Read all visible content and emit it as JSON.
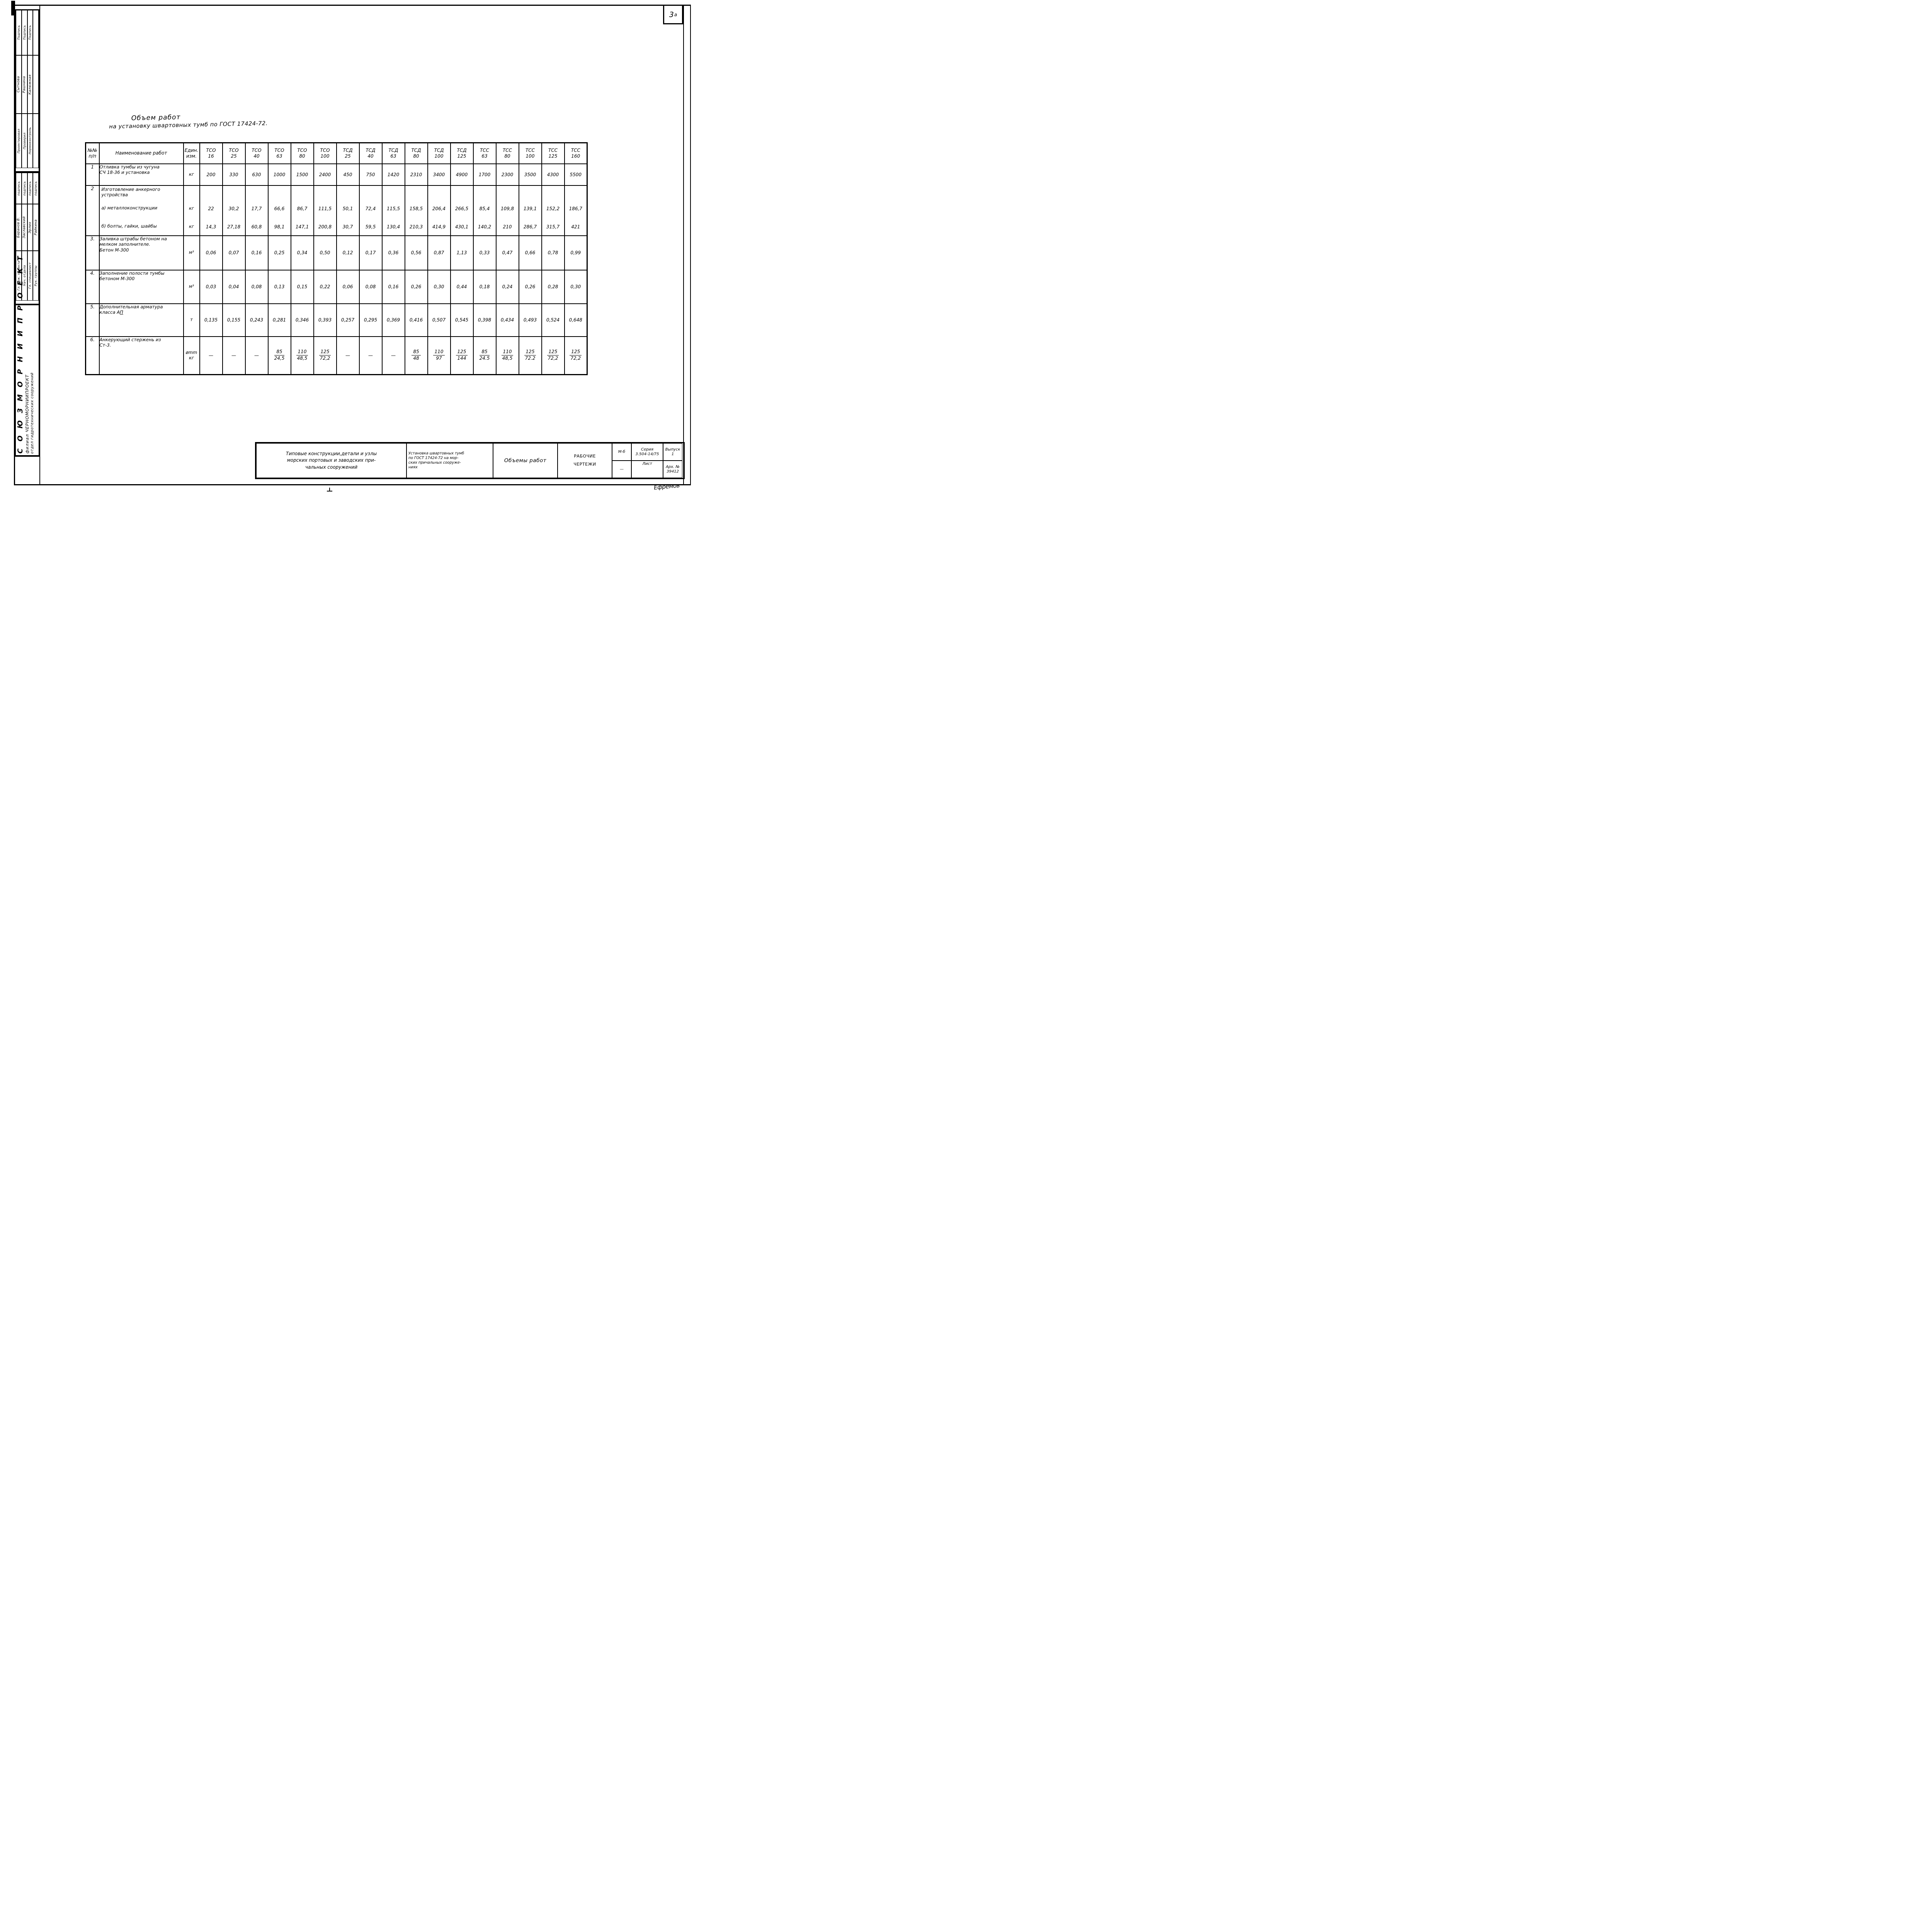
{
  "page": {
    "number": "3",
    "number_sup": "а"
  },
  "title": {
    "line1": "Объем работ",
    "line2": "на установку швартовных тумб по ГОСТ 17424-72."
  },
  "org": {
    "line1": "С О Ю З М О Р Н И И П Р О Е К Т",
    "line2": "филиал  ЧЕРНОМОРНИИПРОЕКТ",
    "line3": "отдел  гидротехнических  сооружений"
  },
  "signoff": {
    "group1": [
      {
        "role": "Проектировал",
        "name": "Сытнова",
        "sign": "Подпись"
      },
      {
        "role": "Проверил",
        "name": "Рашнина",
        "sign": "Подпись"
      },
      {
        "role": "Нормоконтроль",
        "name": "Калюжная",
        "sign": "Подпись"
      },
      {
        "role": "",
        "name": "",
        "sign": ""
      }
    ],
    "group2": [
      {
        "role": "Гл. инж. проекта",
        "name": "Баранов В.",
        "sign": "подпись"
      },
      {
        "role": "Нач. отдела",
        "name": "Заславский",
        "sign": "подпись"
      },
      {
        "role": "Гл. специалист",
        "name": "Эрлих",
        "sign": "подпись"
      },
      {
        "role": "Рук. группы",
        "name": "Райкина",
        "sign": "подпись"
      }
    ]
  },
  "table": {
    "col_headers": {
      "num_lines": [
        "№№",
        "п/п"
      ],
      "name": "Наименование работ",
      "unit_lines": [
        "Един.",
        "изм."
      ]
    },
    "types": [
      {
        "l1": "ТСО",
        "l2": "16"
      },
      {
        "l1": "ТСО",
        "l2": "25"
      },
      {
        "l1": "ТСО",
        "l2": "40"
      },
      {
        "l1": "ТСО",
        "l2": "63"
      },
      {
        "l1": "ТСО",
        "l2": "80"
      },
      {
        "l1": "ТСО",
        "l2": "100"
      },
      {
        "l1": "ТСД",
        "l2": "25"
      },
      {
        "l1": "ТСД",
        "l2": "40"
      },
      {
        "l1": "ТСД",
        "l2": "63"
      },
      {
        "l1": "ТСД",
        "l2": "80"
      },
      {
        "l1": "ТСД",
        "l2": "100"
      },
      {
        "l1": "ТСД",
        "l2": "125"
      },
      {
        "l1": "ТСС",
        "l2": "63"
      },
      {
        "l1": "ТСС",
        "l2": "80"
      },
      {
        "l1": "ТСС",
        "l2": "100"
      },
      {
        "l1": "ТСС",
        "l2": "125"
      },
      {
        "l1": "ТСС",
        "l2": "160"
      }
    ],
    "rows": [
      {
        "num": "1",
        "name_lines": [
          "Отливка тумбы из чугуна",
          "СЧ 18-36 и установка"
        ],
        "unit": "кг",
        "values": [
          "200",
          "330",
          "630",
          "1000",
          "1500",
          "2400",
          "450",
          "750",
          "1420",
          "2310",
          "3400",
          "4900",
          "1700",
          "2300",
          "3500",
          "4300",
          "5500"
        ]
      },
      {
        "num": "2",
        "title_lines": [
          "Изготовление анкерного",
          "устройства"
        ],
        "sub": [
          {
            "label": "а) металлоконструкции",
            "unit": "кг",
            "values": [
              "22",
              "30,2",
              "17,7",
              "66,6",
              "86,7",
              "111,5",
              "50,1",
              "72,4",
              "115,5",
              "158,5",
              "206,4",
              "266,5",
              "85,4",
              "109,8",
              "139,1",
              "152,2",
              "186,7"
            ]
          },
          {
            "label": "б) болты, гайки, шайбы",
            "unit": "кг",
            "values": [
              "14,3",
              "27,18",
              "60,8",
              "98,1",
              "147,1",
              "200,8",
              "30,7",
              "59,5",
              "130,4",
              "210,3",
              "414,9",
              "430,1",
              "140,2",
              "210",
              "286,7",
              "315,7",
              "421"
            ]
          }
        ]
      },
      {
        "num": "3.",
        "name_lines": [
          "Заливка штрабы бетоном на",
          "мелком заполнителе.",
          "Бетон М-300"
        ],
        "unit": "м³",
        "values": [
          "0,06",
          "0,07",
          "0,16",
          "0,25",
          "0,34",
          "0,50",
          "0,12",
          "0,17",
          "0,36",
          "0,56",
          "0,87",
          "1,13",
          "0,33",
          "0,47",
          "0,66",
          "0,78",
          "0,99"
        ]
      },
      {
        "num": "4.",
        "name_lines": [
          "Заполнение полости тумбы",
          "бетоном М-300"
        ],
        "unit": "м³",
        "values": [
          "0,03",
          "0,04",
          "0,08",
          "0,13",
          "0,15",
          "0,22",
          "0,06",
          "0,08",
          "0,16",
          "0,26",
          "0,30",
          "0,44",
          "0,18",
          "0,24",
          "0,26",
          "0,28",
          "0,30"
        ]
      },
      {
        "num": "5.",
        "name_lines": [
          "Дополнительная арматура",
          "класса А"
        ],
        "name_suffix_underline": "П",
        "unit": "т",
        "values": [
          "0,135",
          "0,155",
          "0,243",
          "0,281",
          "0,346",
          "0,393",
          "0,257",
          "0,295",
          "0,369",
          "0,416",
          "0,507",
          "0,545",
          "0,398",
          "0,434",
          "0,493",
          "0,524",
          "0,648"
        ]
      },
      {
        "num": "6.",
        "name_lines": [
          "Анкерующий стержень из",
          "Ст-3."
        ],
        "unit_lines": [
          "ømm",
          "кг"
        ],
        "values": [
          "—",
          "—",
          "—",
          [
            "85",
            "24,5"
          ],
          [
            "110",
            "48,5"
          ],
          [
            "125",
            "72,2"
          ],
          "—",
          "—",
          "—",
          [
            "85",
            "48"
          ],
          [
            "110",
            "97"
          ],
          [
            "125",
            "144"
          ],
          [
            "85",
            "24.5"
          ],
          [
            "110",
            "48,5"
          ],
          [
            "125",
            "72.2"
          ],
          [
            "125",
            "72,2"
          ],
          [
            "125",
            "72,2"
          ]
        ]
      }
    ]
  },
  "stamp": {
    "project_lines": [
      "Типовые конструкции,детали и  узлы",
      "морских портовых и заводских при-",
      "чальных сооружений"
    ],
    "object_lines": [
      "Установка швартовных тумб",
      "по ГОСТ 17424-72 на мор-",
      "ских причальных сооруже-",
      "ниях"
    ],
    "sheet_title": "Объемы работ",
    "doc_type_line1": "РАБОЧИЕ",
    "doc_type_line2": "ЧЕРТЕЖИ",
    "scale_label": "М-б",
    "scale_value": "—",
    "series_label": "Серия",
    "series_value": "3.504-14/75",
    "issue_label": "Выпуск",
    "issue_value": "1",
    "sheet_label": "Лист",
    "arch_label": "Арх. №",
    "arch_value": "39412",
    "signature": "Ефремов"
  }
}
